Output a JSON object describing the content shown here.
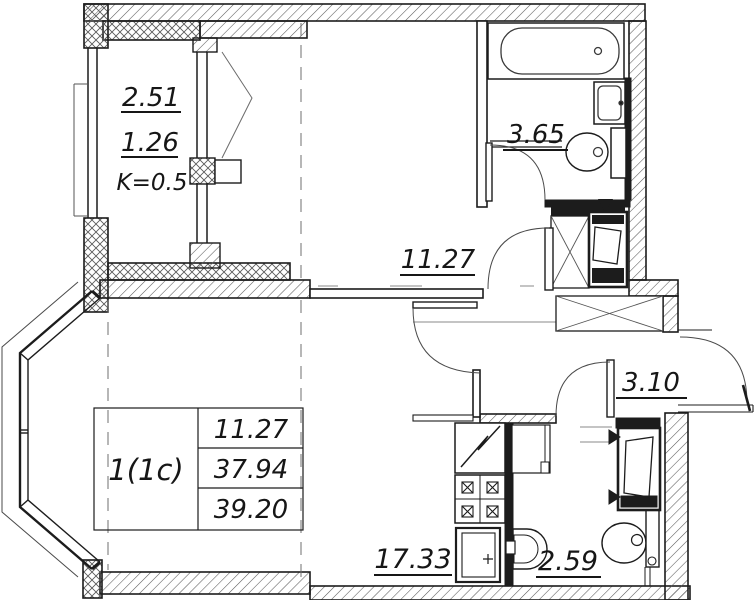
{
  "floor_plan": {
    "balcony": {
      "line1": "2.51",
      "line2": "1.26",
      "line3": "K=0.5"
    },
    "rooms": {
      "room_top_area": "11.27",
      "bathroom_area": "3.65",
      "hallway_area": "3.10",
      "kitchen_area": "17.33",
      "wc_area": "2.59"
    },
    "summary_table": {
      "type_label": "1(1c)",
      "living_area": "11.27",
      "area_without_summer": "37.94",
      "total_area": "39.20"
    },
    "colors": {
      "line": "#1c1c1c",
      "hatch": "#5a5a5a",
      "background": "#ffffff"
    }
  }
}
